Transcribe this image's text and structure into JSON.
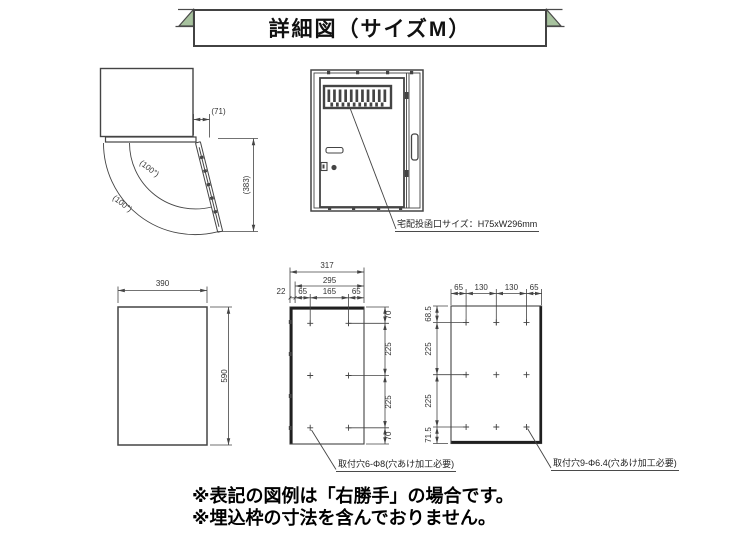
{
  "title": "詳細図（サイズM）",
  "colors": {
    "ribbon_green": "#a7c29e",
    "line": "#444444"
  },
  "top_view": {
    "door_offset": "(71)",
    "open_depth": "(383)",
    "swing_angle_inner": "(100°)",
    "swing_angle_outer": "(100°)"
  },
  "front_view": {
    "slot_label": "宅配投函口サイズ：H75xW296mm"
  },
  "back_panel": {
    "width": "390",
    "height": "590"
  },
  "side_panel": {
    "overall_width": "317",
    "pitch_width": "295",
    "seg_offset": "22",
    "seg_left": "65",
    "seg_center": "165",
    "seg_right": "65",
    "v_top": "70",
    "v_upper": "225",
    "v_lower": "225",
    "v_bottom": "70",
    "note": "取付穴6-Φ8(穴あけ加工必要)"
  },
  "base_panel": {
    "seg1": "65",
    "seg2": "130",
    "seg3": "130",
    "seg4": "65",
    "v1": "68.5",
    "v2": "225",
    "v3": "225",
    "v4": "71.5",
    "note": "取付穴9-Φ6.4(穴あけ加工必要)"
  },
  "footnotes": {
    "line1": "※表記の図例は「右勝手」の場合です。",
    "line2": "※埋込枠の寸法を含んでおりません。"
  }
}
